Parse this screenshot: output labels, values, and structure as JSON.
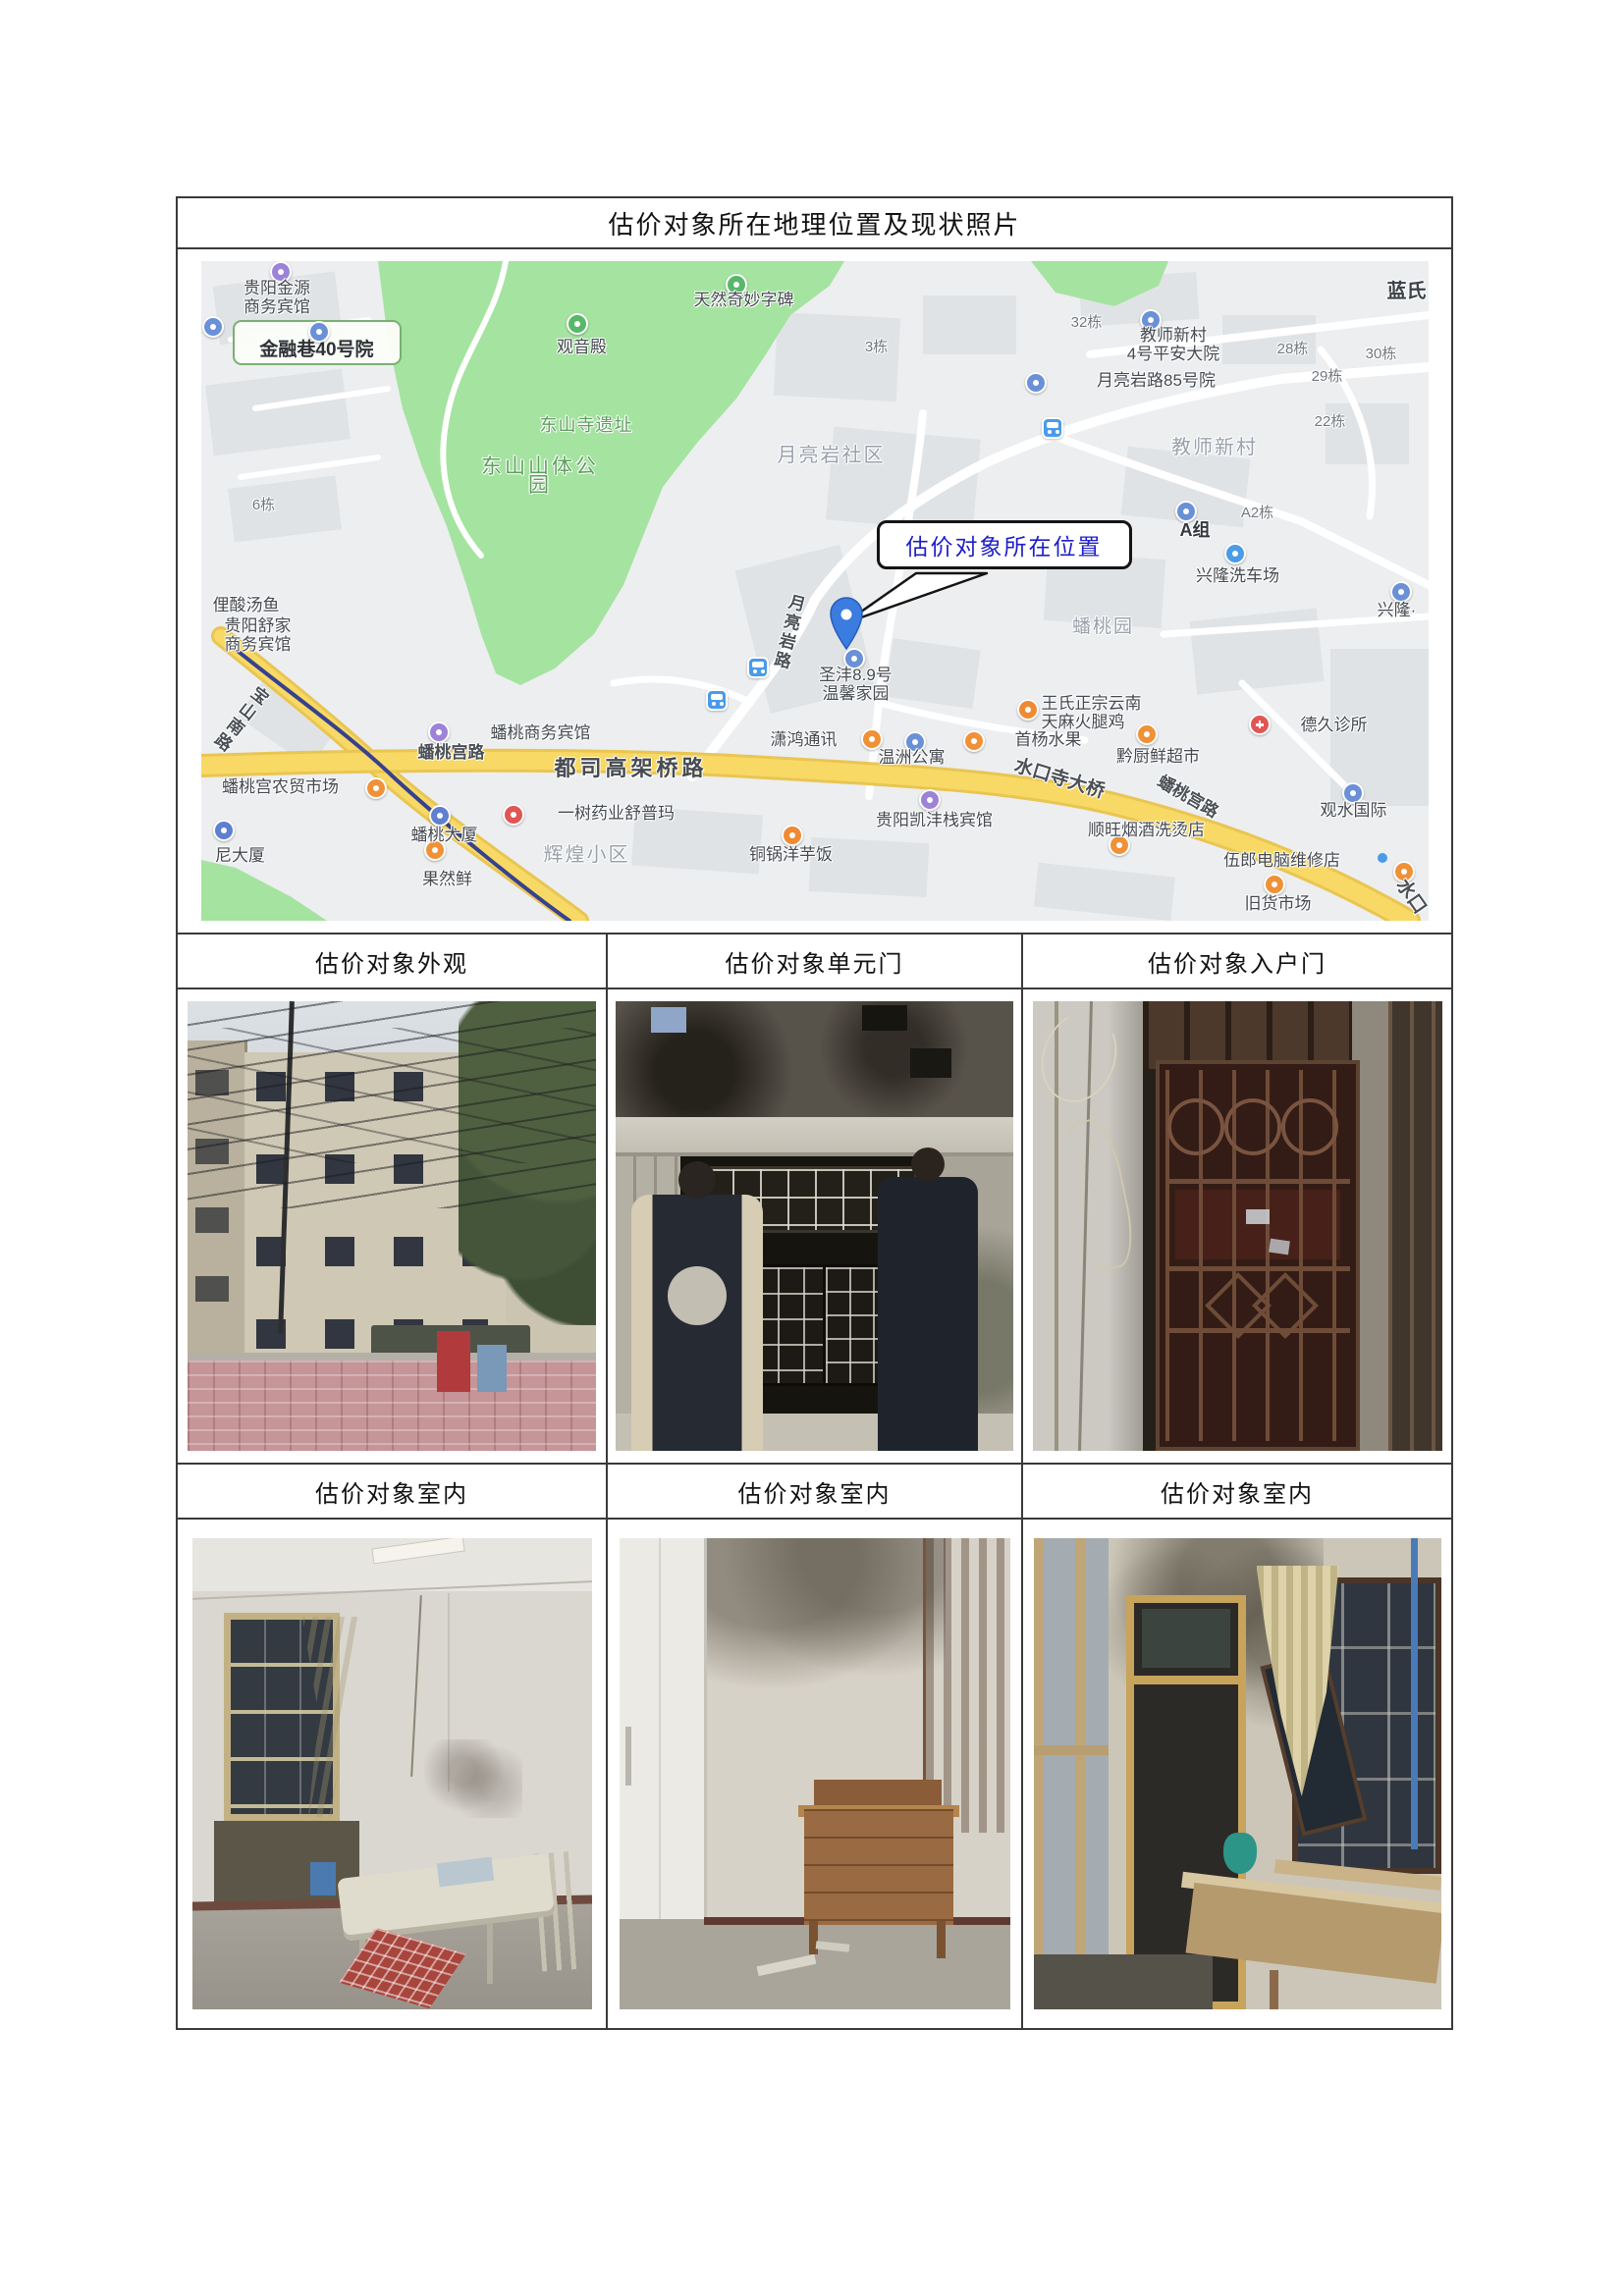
{
  "document": {
    "title": "估价对象所在地理位置及现状照片"
  },
  "table": {
    "row1_headers": [
      "估价对象外观",
      "估价对象单元门",
      "估价对象入户门"
    ],
    "row2_headers": [
      "估价对象室内",
      "估价对象室内",
      "估价对象室内"
    ]
  },
  "map": {
    "callout": "估价对象所在位置",
    "labels": [
      {
        "text": "贵阳金源\n商务宾馆"
      },
      {
        "text": "金融巷40号院"
      },
      {
        "text": "观音殿"
      },
      {
        "text": "天然奇妙字碑"
      },
      {
        "text": "东山寺遗址"
      },
      {
        "text": "东山山体公园"
      },
      {
        "text": "3栋"
      },
      {
        "text": "月亮岩社区"
      },
      {
        "text": "32栋"
      },
      {
        "text": "教师新村\n4号平安大院"
      },
      {
        "text": "28栋"
      },
      {
        "text": "30栋"
      },
      {
        "text": "月亮岩路85号院"
      },
      {
        "text": "29栋"
      },
      {
        "text": "蓝氏"
      },
      {
        "text": "22栋"
      },
      {
        "text": "教师新村"
      },
      {
        "text": "A组"
      },
      {
        "text": "A2栋"
      },
      {
        "text": "兴隆洗车场"
      },
      {
        "text": "兴隆·"
      },
      {
        "text": "蟠桃园"
      },
      {
        "text": "月亮岩路"
      },
      {
        "text": "圣沣8.9号\n温馨家园"
      },
      {
        "text": "王氏正宗云南\n天麻火腿鸡"
      },
      {
        "text": "潇鸿通讯"
      },
      {
        "text": "温洲公寓"
      },
      {
        "text": "首杨水果"
      },
      {
        "text": "黔厨鲜超市"
      },
      {
        "text": "德久诊所"
      },
      {
        "text": "蟠桃商务宾馆"
      },
      {
        "text": "蟠桃宫路"
      },
      {
        "text": "都司高架桥路"
      },
      {
        "text": "蟠桃宫农贸市场"
      },
      {
        "text": "水口寺大桥"
      },
      {
        "text": "蟠桃宫路"
      },
      {
        "text": "观水国际"
      },
      {
        "text": "一树药业舒普玛"
      },
      {
        "text": "蟠桃大厦"
      },
      {
        "text": "辉煌小区"
      },
      {
        "text": "贵阳凯沣栈宾馆"
      },
      {
        "text": "顺旺烟酒洗烫店"
      },
      {
        "text": "铜锅洋芋饭"
      },
      {
        "text": "伍郎电脑维修店"
      },
      {
        "text": "旧货市场"
      },
      {
        "text": "尼大厦"
      },
      {
        "text": "俚酸汤鱼"
      },
      {
        "text": "贵阳舒家\n商务宾馆"
      },
      {
        "text": "果然鲜"
      },
      {
        "text": "6栋"
      },
      {
        "text": "宝山南路"
      },
      {
        "text": "水口"
      }
    ],
    "colors": {
      "park_green": "#a5e3a0",
      "road_yellow": "#f8d965",
      "railway_blue": "#36418f",
      "pin_blue": "#3a7ce0",
      "callout_text_blue": "#1e1ec8"
    }
  }
}
